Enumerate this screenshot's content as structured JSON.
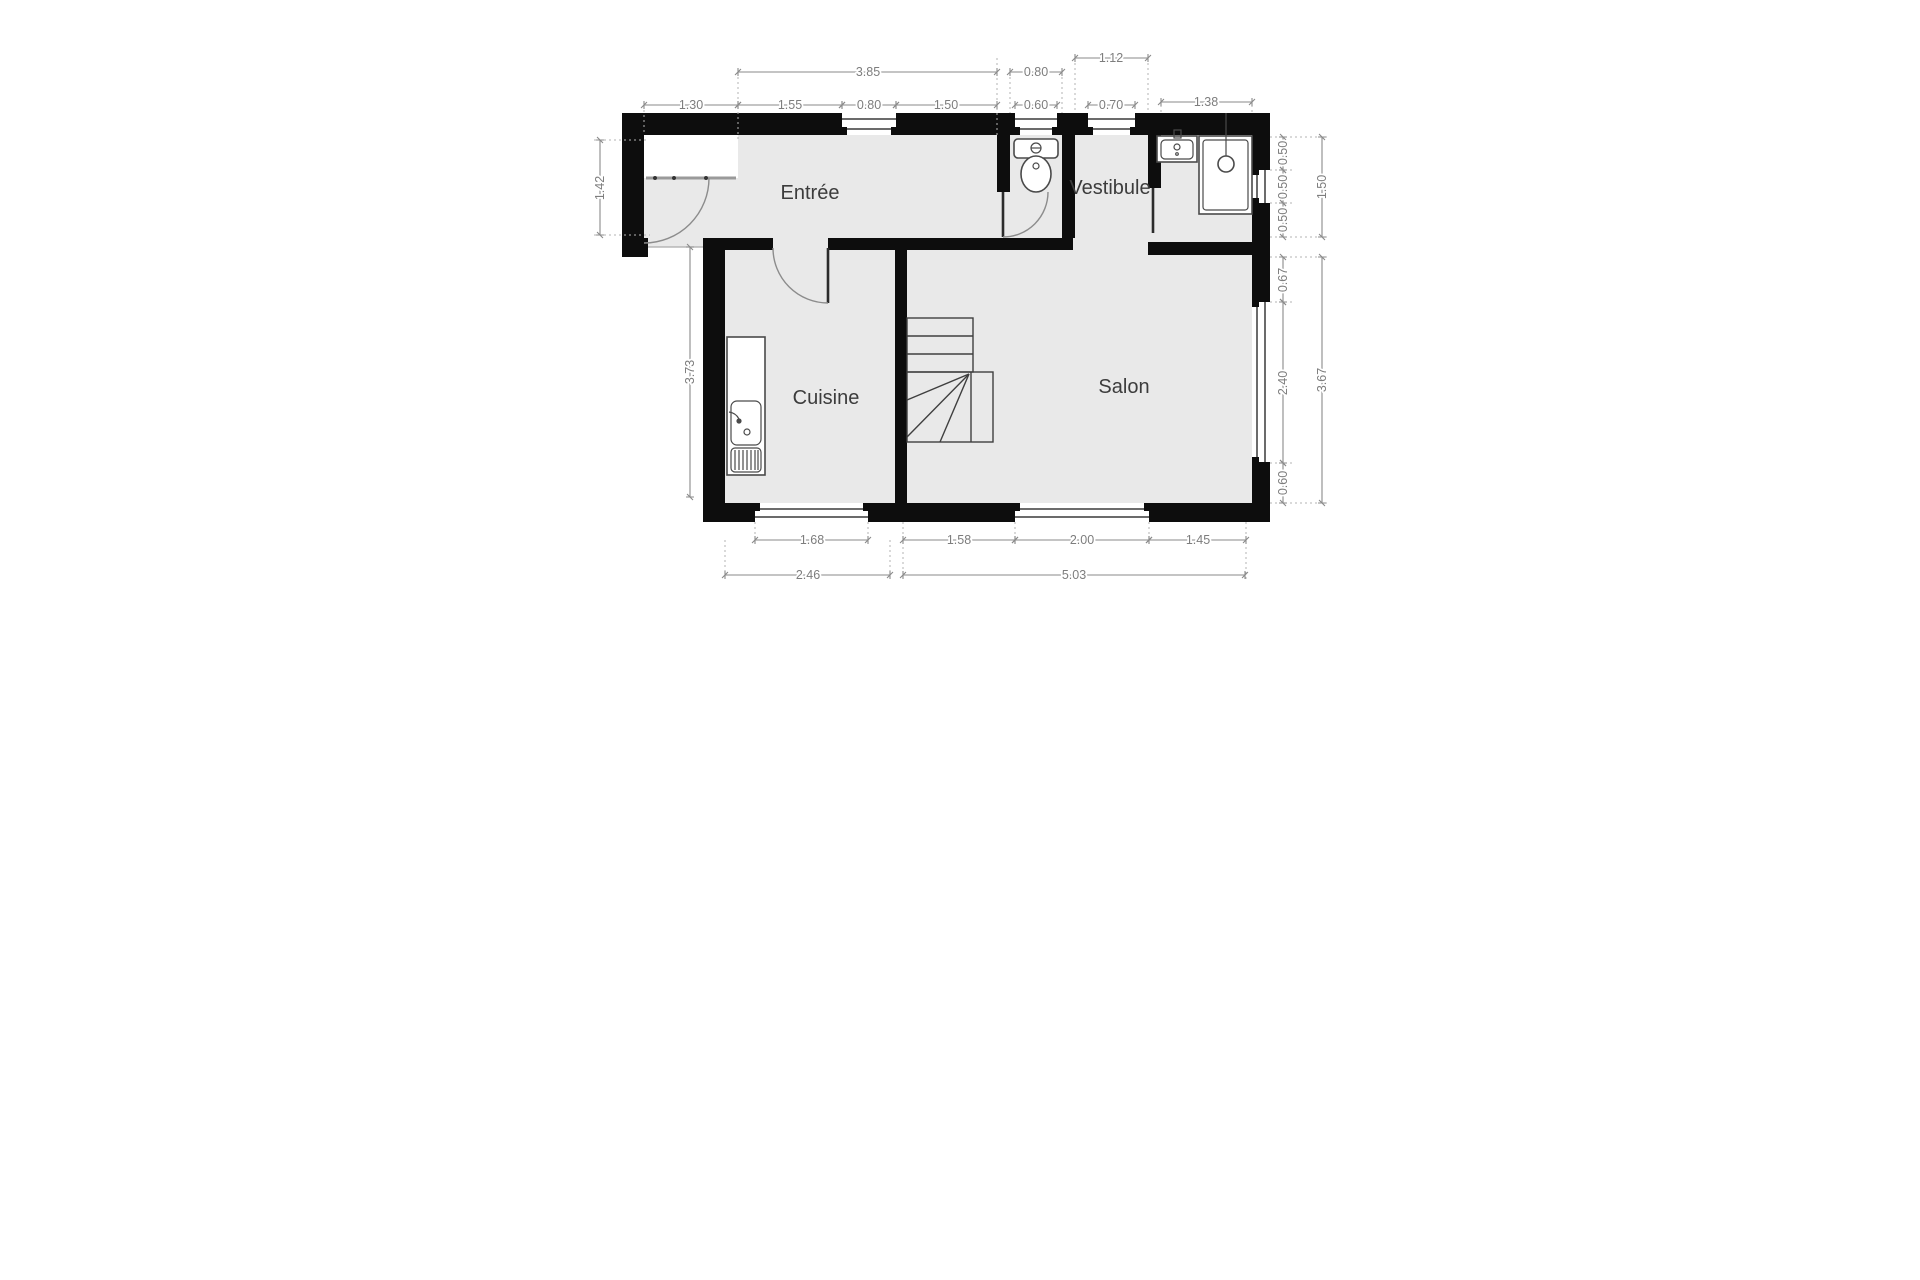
{
  "plan": {
    "title": "floor-plan-ground-level",
    "rooms": [
      {
        "name": "Entrée"
      },
      {
        "name": "Vestibule"
      },
      {
        "name": "Cuisine"
      },
      {
        "name": "Salon"
      }
    ],
    "fixtures": [
      "toilet",
      "washbasin",
      "shower",
      "kitchen-sink",
      "staircase",
      "entry-door",
      "interior-doors",
      "windows"
    ],
    "dims": {
      "top_inner": [
        "1.30",
        "1.55",
        "0.80",
        "1.50",
        "0.60",
        "0.70",
        "1.38"
      ],
      "top_mid": [
        "3.85",
        "0.80"
      ],
      "top_outer": [
        "1.12"
      ],
      "left": [
        "1.42",
        "3.73"
      ],
      "bottom_inner": [
        "1.68",
        "1.58",
        "2.00",
        "1.45"
      ],
      "bottom_outer": [
        "2.46",
        "5.03"
      ],
      "right_inner": [
        "0.50",
        "0.50",
        "0.50",
        "0.67",
        "2.40",
        "0.60"
      ],
      "right_outer": [
        "1.50",
        "3.67"
      ]
    },
    "colors": {
      "wall": "#0d0d0d",
      "floor": "#e9e9e9",
      "dimension_text": "#7d7d7d",
      "room_label": "#3c3c3c",
      "background": "#ffffff"
    }
  }
}
